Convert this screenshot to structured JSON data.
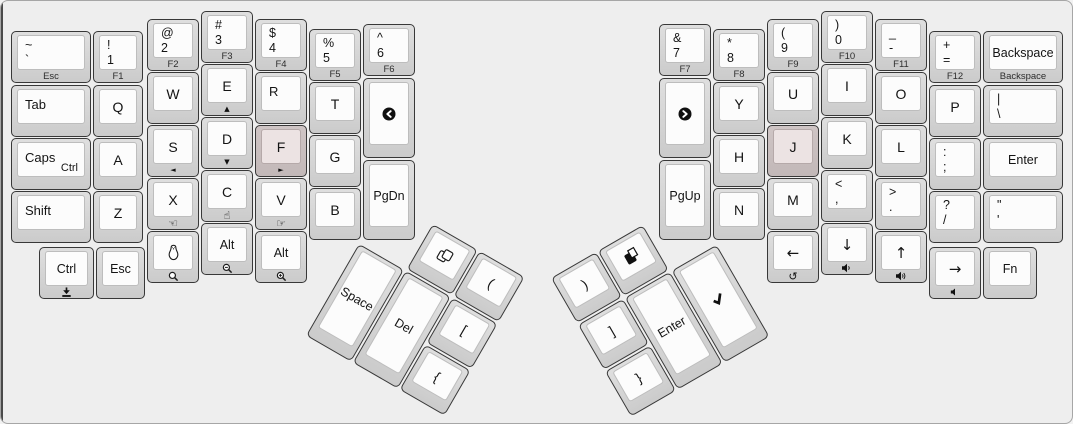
{
  "canvas": {
    "width": 1073,
    "height": 424,
    "background": "#eeeeee",
    "border_color": "#a6a6a6"
  },
  "colors": {
    "key_side": "#d4d4d4",
    "key_top": "#fcfcfc",
    "key_outline": "#383838",
    "homing_key_side": "#c8bebe",
    "homing_key_top": "#ece3e3",
    "legend": "#141414"
  },
  "clusters": [
    {
      "id": "left-thumb",
      "x": 385,
      "y": 196,
      "rotation": 30
    },
    {
      "id": "right-thumb",
      "x": 550,
      "y": 277,
      "rotation": -30
    }
  ],
  "keys": [
    {
      "id": "grave",
      "x": 10,
      "y": 30,
      "w": 80,
      "h": 52,
      "shift": "~",
      "base": "`",
      "front": "Esc"
    },
    {
      "id": "1",
      "x": 92,
      "y": 30,
      "w": 50,
      "h": 52,
      "shift": "!",
      "base": "1",
      "front": "F1"
    },
    {
      "id": "2",
      "x": 146,
      "y": 18,
      "w": 52,
      "h": 52,
      "shift": "@",
      "base": "2",
      "front": "F2"
    },
    {
      "id": "3",
      "x": 200,
      "y": 10,
      "w": 52,
      "h": 52,
      "shift": "#",
      "base": "3",
      "front": "F3"
    },
    {
      "id": "4",
      "x": 254,
      "y": 18,
      "w": 52,
      "h": 52,
      "shift": "$",
      "base": "4",
      "front": "F4"
    },
    {
      "id": "5",
      "x": 308,
      "y": 28,
      "w": 52,
      "h": 52,
      "shift": "%",
      "base": "5",
      "front": "F5"
    },
    {
      "id": "6",
      "x": 362,
      "y": 23,
      "w": 52,
      "h": 52,
      "shift": "^",
      "base": "6",
      "front": "F6"
    },
    {
      "id": "tab",
      "x": 10,
      "y": 84,
      "w": 80,
      "h": 52,
      "left": "Tab"
    },
    {
      "id": "q",
      "x": 92,
      "y": 84,
      "w": 50,
      "h": 52,
      "center": "Q"
    },
    {
      "id": "w",
      "x": 146,
      "y": 71,
      "w": 52,
      "h": 52,
      "center": "W"
    },
    {
      "id": "e",
      "x": 200,
      "y": 63,
      "w": 52,
      "h": 52,
      "center": "E",
      "front_icon": "triangle-up-icon"
    },
    {
      "id": "r",
      "x": 254,
      "y": 71,
      "w": 52,
      "h": 52,
      "left": "R"
    },
    {
      "id": "t",
      "x": 308,
      "y": 81,
      "w": 52,
      "h": 52,
      "center": "T"
    },
    {
      "id": "prev-track",
      "x": 362,
      "y": 77,
      "w": 52,
      "h": 80,
      "icon": "prev-track-icon"
    },
    {
      "id": "caps",
      "x": 10,
      "y": 137,
      "w": 80,
      "h": 52,
      "left": "Caps",
      "corner": "Ctrl"
    },
    {
      "id": "a",
      "x": 92,
      "y": 137,
      "w": 50,
      "h": 52,
      "center": "A"
    },
    {
      "id": "s",
      "x": 146,
      "y": 124,
      "w": 52,
      "h": 52,
      "center": "S",
      "front_icon": "triangle-left-icon"
    },
    {
      "id": "d",
      "x": 200,
      "y": 116,
      "w": 52,
      "h": 52,
      "center": "D",
      "front_icon": "triangle-down-icon"
    },
    {
      "id": "f",
      "x": 254,
      "y": 124,
      "w": 52,
      "h": 52,
      "center": "F",
      "front_icon": "triangle-right-icon",
      "homing": true
    },
    {
      "id": "g",
      "x": 308,
      "y": 134,
      "w": 52,
      "h": 52,
      "center": "G"
    },
    {
      "id": "shift",
      "x": 10,
      "y": 190,
      "w": 80,
      "h": 52,
      "left": "Shift"
    },
    {
      "id": "z",
      "x": 92,
      "y": 190,
      "w": 50,
      "h": 52,
      "center": "Z"
    },
    {
      "id": "x",
      "x": 146,
      "y": 177,
      "w": 52,
      "h": 52,
      "center": "X",
      "front_icon": "hand-thumb-left-icon"
    },
    {
      "id": "c",
      "x": 200,
      "y": 169,
      "w": 52,
      "h": 52,
      "center": "C",
      "front_icon": "hand-pointer-icon"
    },
    {
      "id": "v",
      "x": 254,
      "y": 177,
      "w": 52,
      "h": 52,
      "center": "V",
      "front_icon": "hand-thumb-right-icon"
    },
    {
      "id": "b",
      "x": 308,
      "y": 187,
      "w": 52,
      "h": 52,
      "center": "B"
    },
    {
      "id": "pgdn",
      "x": 362,
      "y": 159,
      "w": 52,
      "h": 80,
      "center": "PgDn"
    },
    {
      "id": "lctrl",
      "x": 38,
      "y": 246,
      "w": 55,
      "h": 52,
      "center": "Ctrl",
      "front_icon": "download-icon"
    },
    {
      "id": "lesc",
      "x": 95,
      "y": 246,
      "w": 49,
      "h": 52,
      "center": "Esc"
    },
    {
      "id": "linux",
      "x": 146,
      "y": 230,
      "w": 52,
      "h": 52,
      "icon": "linux-penguin-icon",
      "front_icon": "search-icon"
    },
    {
      "id": "lalt1",
      "x": 200,
      "y": 222,
      "w": 52,
      "h": 52,
      "center": "Alt",
      "front_icon": "zoom-out-icon"
    },
    {
      "id": "lalt2",
      "x": 254,
      "y": 230,
      "w": 52,
      "h": 52,
      "center": "Alt",
      "front_icon": "zoom-in-icon"
    },
    {
      "id": "7",
      "x": 658,
      "y": 23,
      "w": 52,
      "h": 52,
      "shift": "&",
      "base": "7",
      "front": "F7"
    },
    {
      "id": "8",
      "x": 712,
      "y": 28,
      "w": 52,
      "h": 52,
      "shift": "*",
      "base": "8",
      "front": "F8"
    },
    {
      "id": "9",
      "x": 766,
      "y": 18,
      "w": 52,
      "h": 52,
      "shift": "(",
      "base": "9",
      "front": "F9"
    },
    {
      "id": "0",
      "x": 820,
      "y": 10,
      "w": 52,
      "h": 52,
      "shift": ")",
      "base": "0",
      "front": "F10"
    },
    {
      "id": "minus",
      "x": 874,
      "y": 18,
      "w": 52,
      "h": 52,
      "shift": "_",
      "base": "-",
      "front": "F11"
    },
    {
      "id": "equals",
      "x": 928,
      "y": 30,
      "w": 52,
      "h": 52,
      "shift": "+",
      "base": "=",
      "front": "F12"
    },
    {
      "id": "backspace",
      "x": 982,
      "y": 30,
      "w": 80,
      "h": 52,
      "center": "Backspace",
      "front": "Backspace"
    },
    {
      "id": "next-track",
      "x": 658,
      "y": 77,
      "w": 52,
      "h": 80,
      "icon": "next-track-icon"
    },
    {
      "id": "y",
      "x": 712,
      "y": 81,
      "w": 52,
      "h": 52,
      "center": "Y"
    },
    {
      "id": "u",
      "x": 766,
      "y": 71,
      "w": 52,
      "h": 52,
      "center": "U"
    },
    {
      "id": "i",
      "x": 820,
      "y": 63,
      "w": 52,
      "h": 52,
      "center": "I"
    },
    {
      "id": "o",
      "x": 874,
      "y": 71,
      "w": 52,
      "h": 52,
      "center": "O"
    },
    {
      "id": "p",
      "x": 928,
      "y": 84,
      "w": 52,
      "h": 52,
      "center": "P"
    },
    {
      "id": "backslash",
      "x": 982,
      "y": 84,
      "w": 80,
      "h": 52,
      "shift": "|",
      "base": "\\"
    },
    {
      "id": "pgup",
      "x": 658,
      "y": 159,
      "w": 52,
      "h": 80,
      "center": "PgUp"
    },
    {
      "id": "h",
      "x": 712,
      "y": 134,
      "w": 52,
      "h": 52,
      "center": "H"
    },
    {
      "id": "j",
      "x": 766,
      "y": 124,
      "w": 52,
      "h": 52,
      "center": "J",
      "homing": true
    },
    {
      "id": "k",
      "x": 820,
      "y": 116,
      "w": 52,
      "h": 52,
      "center": "K"
    },
    {
      "id": "l",
      "x": 874,
      "y": 124,
      "w": 52,
      "h": 52,
      "center": "L"
    },
    {
      "id": "semicolon",
      "x": 928,
      "y": 137,
      "w": 52,
      "h": 52,
      "shift": ":",
      "base": ";"
    },
    {
      "id": "enter",
      "x": 982,
      "y": 137,
      "w": 80,
      "h": 52,
      "center": "Enter"
    },
    {
      "id": "n",
      "x": 712,
      "y": 187,
      "w": 52,
      "h": 52,
      "center": "N"
    },
    {
      "id": "m",
      "x": 766,
      "y": 177,
      "w": 52,
      "h": 52,
      "center": "M"
    },
    {
      "id": "comma",
      "x": 820,
      "y": 169,
      "w": 52,
      "h": 52,
      "shift": "<",
      "base": ","
    },
    {
      "id": "period",
      "x": 874,
      "y": 177,
      "w": 52,
      "h": 52,
      "shift": ">",
      "base": "."
    },
    {
      "id": "slash",
      "x": 928,
      "y": 190,
      "w": 52,
      "h": 52,
      "shift": "?",
      "base": "/"
    },
    {
      "id": "quote",
      "x": 982,
      "y": 190,
      "w": 80,
      "h": 52,
      "shift": "\"",
      "base": "'"
    },
    {
      "id": "arrow-left",
      "x": 766,
      "y": 230,
      "w": 52,
      "h": 52,
      "center": "←",
      "arrow": true,
      "front_icon": "undo-icon"
    },
    {
      "id": "arrow-down",
      "x": 820,
      "y": 222,
      "w": 52,
      "h": 52,
      "center": "↓",
      "arrow": true,
      "front_icon": "volume-down-icon"
    },
    {
      "id": "arrow-up",
      "x": 874,
      "y": 230,
      "w": 52,
      "h": 52,
      "center": "↑",
      "arrow": true,
      "front_icon": "volume-up-icon"
    },
    {
      "id": "arrow-right",
      "x": 928,
      "y": 246,
      "w": 52,
      "h": 52,
      "center": "→",
      "arrow": true,
      "front_icon": "volume-mute-icon"
    },
    {
      "id": "fn",
      "x": 982,
      "y": 246,
      "w": 54,
      "h": 52,
      "center": "Fn"
    },
    {
      "id": "copy",
      "cluster": "left-thumb",
      "x": 54,
      "y": 0,
      "w": 52,
      "h": 52,
      "icon": "copy-icon"
    },
    {
      "id": "lparen",
      "cluster": "left-thumb",
      "x": 108,
      "y": 0,
      "w": 52,
      "h": 52,
      "center": "("
    },
    {
      "id": "space",
      "cluster": "left-thumb",
      "x": 0,
      "y": 54,
      "w": 52,
      "h": 106,
      "center": "Space"
    },
    {
      "id": "del",
      "cluster": "left-thumb",
      "x": 54,
      "y": 54,
      "w": 52,
      "h": 106,
      "center": "Del"
    },
    {
      "id": "lbracket",
      "cluster": "left-thumb",
      "x": 108,
      "y": 54,
      "w": 52,
      "h": 52,
      "center": "["
    },
    {
      "id": "lbrace",
      "cluster": "left-thumb",
      "x": 108,
      "y": 108,
      "w": 52,
      "h": 52,
      "center": "{"
    },
    {
      "id": "rparen",
      "cluster": "right-thumb",
      "x": 0,
      "y": 0,
      "w": 52,
      "h": 52,
      "center": ")"
    },
    {
      "id": "paste",
      "cluster": "right-thumb",
      "x": 54,
      "y": 0,
      "w": 52,
      "h": 52,
      "icon": "paste-icon"
    },
    {
      "id": "rbracket",
      "cluster": "right-thumb",
      "x": 0,
      "y": 54,
      "w": 52,
      "h": 52,
      "center": "]"
    },
    {
      "id": "rbrace",
      "cluster": "right-thumb",
      "x": 0,
      "y": 108,
      "w": 52,
      "h": 52,
      "center": "}"
    },
    {
      "id": "enter-thumb",
      "cluster": "right-thumb",
      "x": 54,
      "y": 54,
      "w": 52,
      "h": 106,
      "center": "Enter"
    },
    {
      "id": "check",
      "cluster": "right-thumb",
      "x": 108,
      "y": 54,
      "w": 52,
      "h": 106,
      "icon": "check-icon"
    }
  ]
}
